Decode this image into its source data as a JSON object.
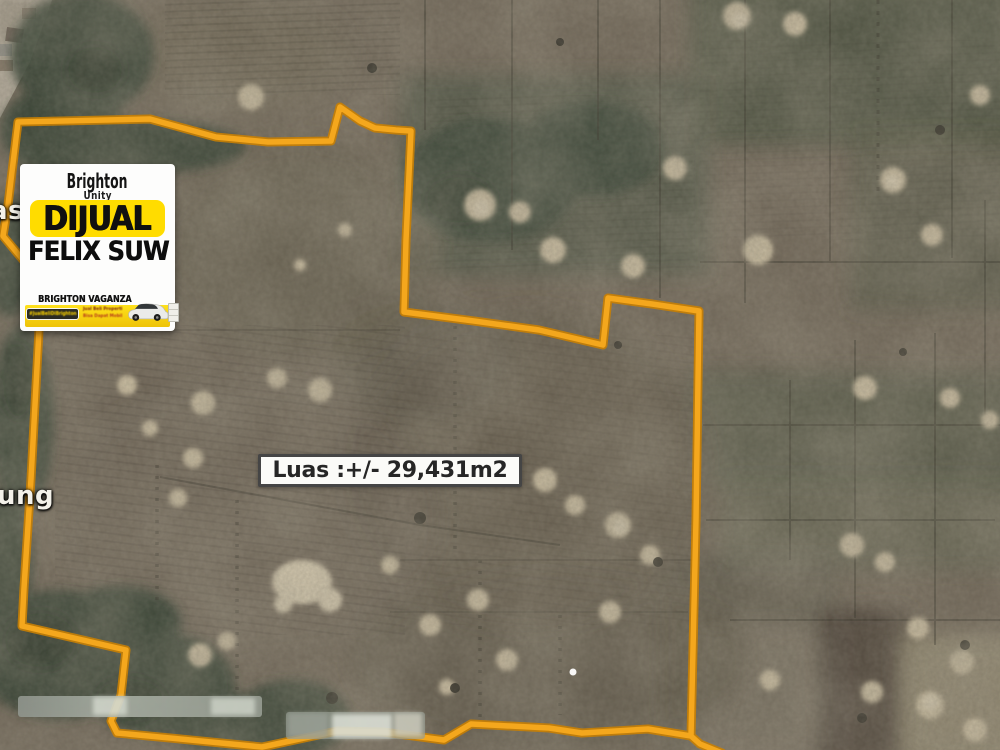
{
  "map": {
    "type": "satellite-aerial-farmland",
    "place_labels": [
      {
        "text": "asa"
      },
      {
        "text": "ung"
      }
    ],
    "area_label": {
      "text": "Luas :+/- 29,431m2"
    },
    "boundary": {
      "color": "#F4A71D",
      "casing_color": "#C87F04",
      "points": "722,753 700,744 691,736 648,729 582,733 549,728 471,724 444,740 383,732 337,731 262,747 170,738 117,733 111,721 121,695 126,650 22,626 24,588 31,479 41,293 44,285 3,236 8,205 18,122 150,119 216,137 268,142 331,141 340,107 360,121 375,128 396,130 411,131 406,240 404,312 474,321 539,330 603,345 608,298 652,304 699,311 696,520 691,736"
    }
  },
  "card": {
    "brand": "Brighton",
    "brand_sub": "Unity",
    "status": "DIJUAL",
    "agent_name": "FELIX SUW",
    "promo": {
      "title": "BRIGHTON VAGANZA",
      "badge_text": "#JualBeliDiBrighton",
      "line1": "Jual Beli Properti",
      "line2": "Bisa Dapat Mobil"
    },
    "colors": {
      "accent_yellow": "#FFDC00",
      "banner_yellow": "#F5CB0A",
      "text_black": "#111111"
    }
  }
}
